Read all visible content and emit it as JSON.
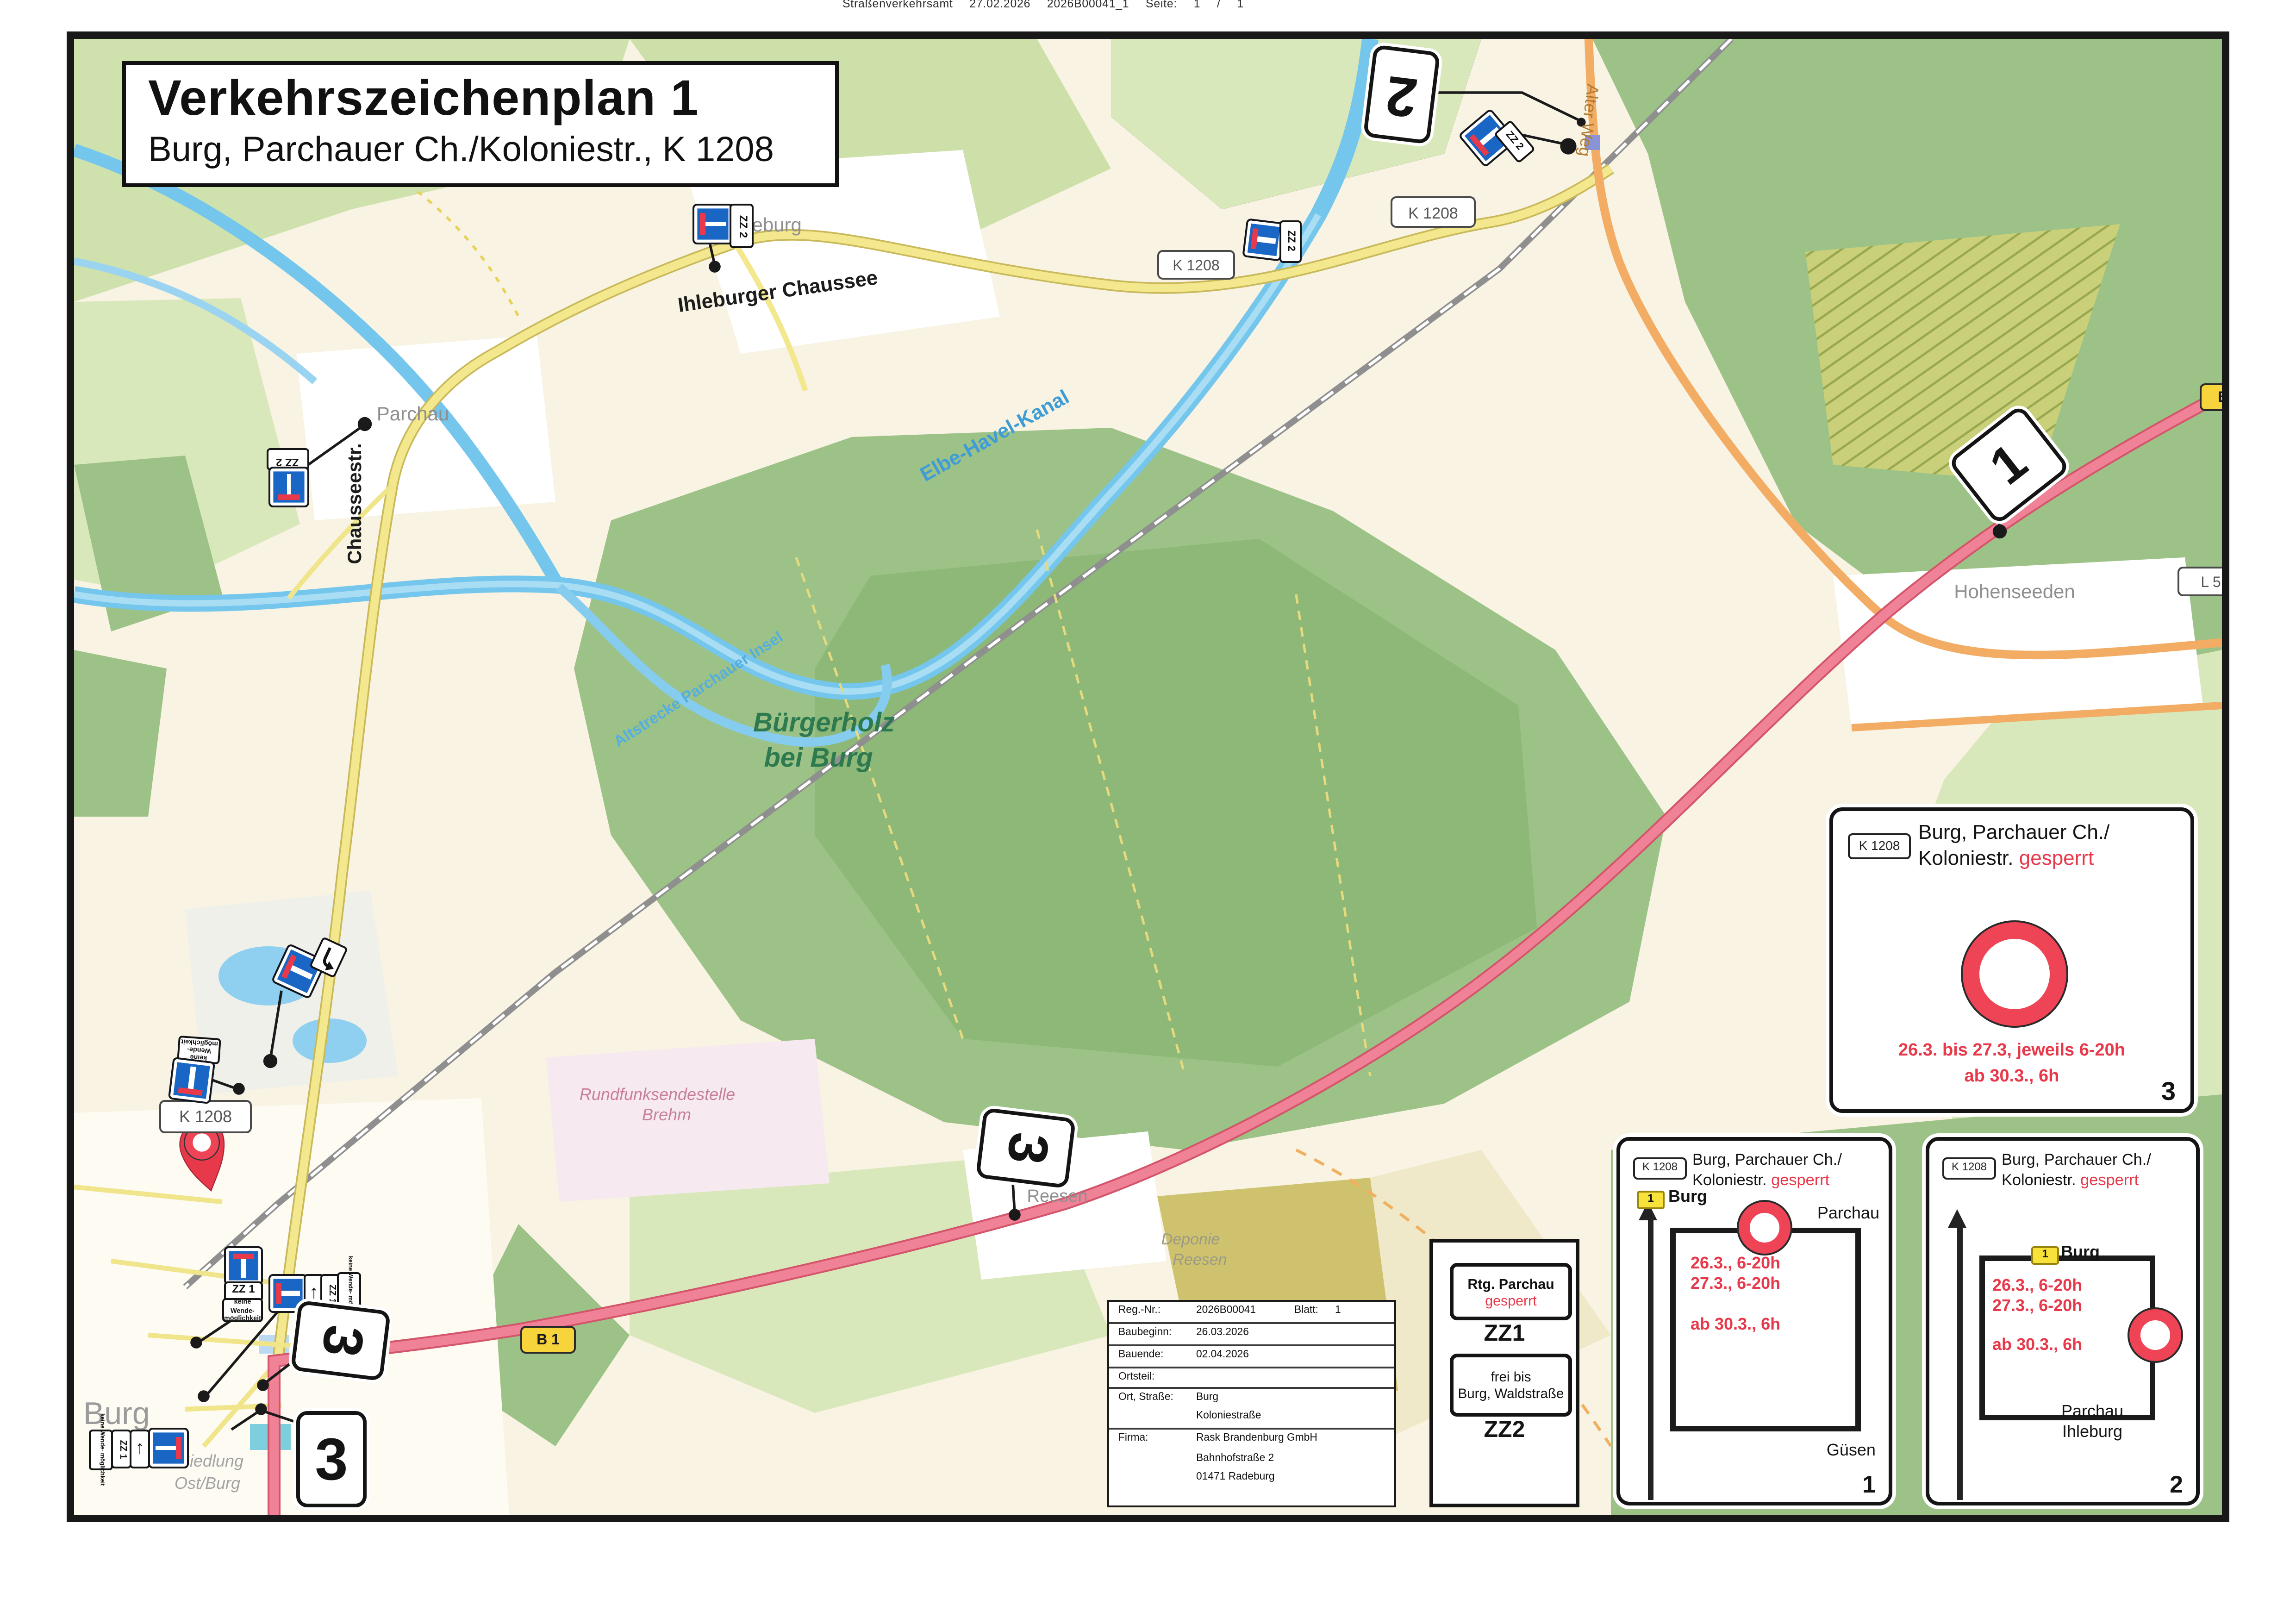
{
  "page_header": "Straßenverkehrsamt  27.02.2026   2026B00041_1   Seite: 1 / 1",
  "title_box": {
    "title": "Verkehrszeichenplan 1",
    "subtitle": "Burg, Parchauer Ch./Koloniestr., K 1208"
  },
  "map": {
    "towns": {
      "ihleburg": "Ihleburg",
      "parchau": "Parchau",
      "hohenseeden": "Hohenseeden",
      "reesen": "Reesen",
      "burg": "Burg"
    },
    "streets": {
      "ihleburger_chaussee": "Ihleburger Chaussee",
      "chausseestr": "Chausseestr.",
      "alter_weg": "Alter Weg"
    },
    "water": {
      "kanal": "Elbe-Havel-Kanal",
      "altstrecke": "Altstrecke Parchauer Insel"
    },
    "areas": {
      "buergerholz1": "Bürgerholz",
      "buergerholz2": "bei Burg",
      "deponie1": "Deponie",
      "deponie2": "Reesen",
      "brehm1": "Rundfunksendestelle",
      "brehm2": "Brehm",
      "siedlung1": "Siedlung",
      "siedlung2": "Ost/Burg"
    },
    "badges": {
      "k1208": "K 1208",
      "b1": "B 1",
      "l5": "L 5"
    },
    "markers": {
      "m1": "1",
      "m2": "2",
      "m3": "3"
    },
    "plaques": {
      "zz1": "ZZ 1",
      "zz2": "ZZ 2",
      "kw1": "keine Wende-",
      "kw2": "möglichkeit",
      "arrow_up": "↑"
    },
    "colors": {
      "closure_red": "#e8394b",
      "sign_blue": "#1a66c4",
      "route_yellow": "#f8d43c"
    }
  },
  "legend": {
    "zz1_line1": "Rtg. Parchau",
    "zz1_line2": "gesperrt",
    "zz1_name": "ZZ1",
    "zz2_line1": "frei bis",
    "zz2_line2": "Burg, Waldstraße",
    "zz2_name": "ZZ2"
  },
  "info_table": {
    "reg_label": "Reg.-Nr.:",
    "reg_value": "2026B00041",
    "blatt_label": "Blatt:",
    "blatt_value": "1",
    "baubeginn_label": "Baubeginn:",
    "baubeginn_value": "26.03.2026",
    "bauende_label": "Bauende:",
    "bauende_value": "02.04.2026",
    "ortsteil_label": "Ortsteil:",
    "ortsteil_value": "",
    "ort_label": "Ort, Straße:",
    "ort_value1": "Burg",
    "ort_value2": "Koloniestraße",
    "firma_label": "Firma:",
    "firma_value1": "Rask Brandenburg GmbH",
    "firma_value2": "Bahnhofstraße 2",
    "firma_value3": "01471 Radeburg"
  },
  "boxes": {
    "badge": "K 1208",
    "title1": "Burg, Parchauer Ch./",
    "title2": "Koloniestr.",
    "gesperrt": "gesperrt",
    "box1": {
      "route": "1",
      "top": "Burg",
      "right": "Parchau",
      "bottom": "Güsen",
      "t1": "26.3., 6-20h",
      "t2": "27.3., 6-20h",
      "t3": "ab 30.3., 6h",
      "num": "1"
    },
    "box2": {
      "route": "1",
      "top": "Burg",
      "b1": "Parchau",
      "b2": "Ihleburg",
      "t1": "26.3., 6-20h",
      "t2": "27.3., 6-20h",
      "t3": "ab 30.3., 6h",
      "num": "2"
    },
    "box3": {
      "t1": "26.3. bis 27.3, jeweils 6-20h",
      "t2": "ab 30.3., 6h",
      "num": "3"
    }
  }
}
